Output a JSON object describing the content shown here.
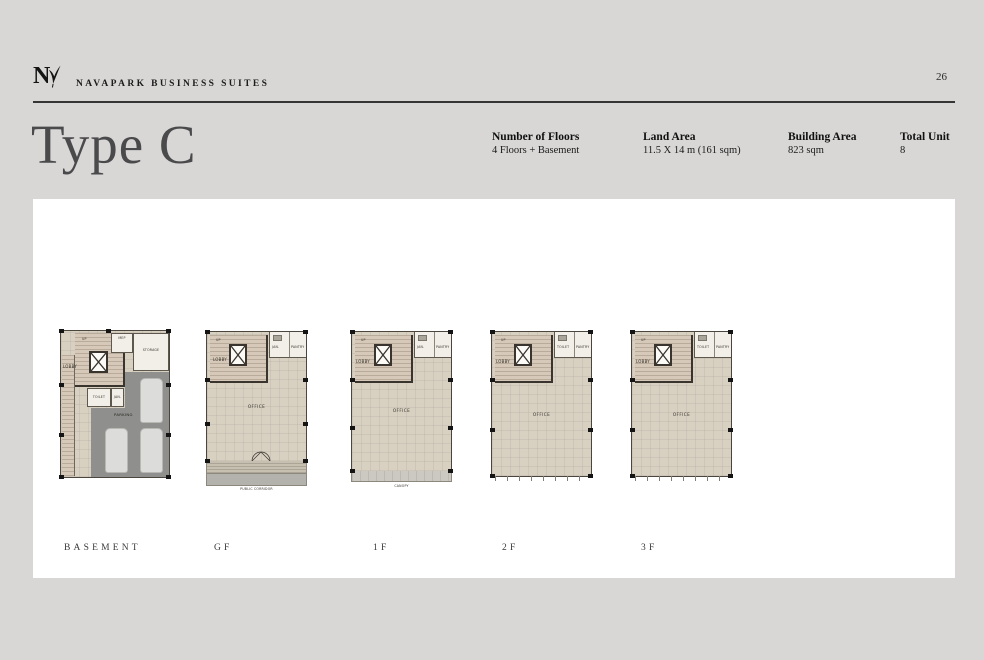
{
  "page": {
    "number": "26"
  },
  "brand": {
    "logo_n": "N",
    "name": "NAVAPARK BUSINESS SUITES"
  },
  "title": "Type C",
  "specs": [
    {
      "label": "Number of Floors",
      "value": "4 Floors + Basement"
    },
    {
      "label": "Land Area",
      "value": "11.5 X 14 m (161 sqm)"
    },
    {
      "label": "Building Area",
      "value": "823 sqm"
    },
    {
      "label": "Total Unit",
      "value": "8"
    }
  ],
  "floors": {
    "basement": {
      "name": "BASEMENT",
      "rooms": {
        "up": "UP",
        "lobby": "LOBBY",
        "mep": "MEP",
        "storage": "STORAGE",
        "toilet": "TOILET",
        "jan": "JAN.",
        "parking": "PARKING"
      }
    },
    "gf": {
      "name": "GF",
      "rooms": {
        "up": "UP",
        "lobby": "LOBBY",
        "jan": "JAN.",
        "pantry": "PANTRY",
        "office": "OFFICE",
        "terrace": "TERRACE",
        "corridor": "PUBLIC CORRIDOR"
      }
    },
    "f1": {
      "name": "1F",
      "rooms": {
        "up": "UP",
        "lobby": "LOBBY",
        "jan": "JAN.",
        "pantry": "PANTRY",
        "office": "OFFICE",
        "canopy": "CANOPY"
      }
    },
    "f2": {
      "name": "2F",
      "rooms": {
        "up": "UP",
        "lobby": "LOBBY",
        "toilet": "TOILET",
        "pantry": "PANTRY",
        "office": "OFFICE"
      }
    },
    "f3": {
      "name": "3F",
      "rooms": {
        "up": "UP",
        "lobby": "LOBBY",
        "toilet": "TOILET",
        "pantry": "PANTRY",
        "office": "OFFICE"
      }
    }
  },
  "colors": {
    "page_bg": "#d8d7d5",
    "panel": "#ffffff",
    "title_text": "#4a4a4c",
    "wall": "#39342d",
    "floor_beige": "#d8d1c2",
    "parking_gray": "#8f8f8d"
  }
}
